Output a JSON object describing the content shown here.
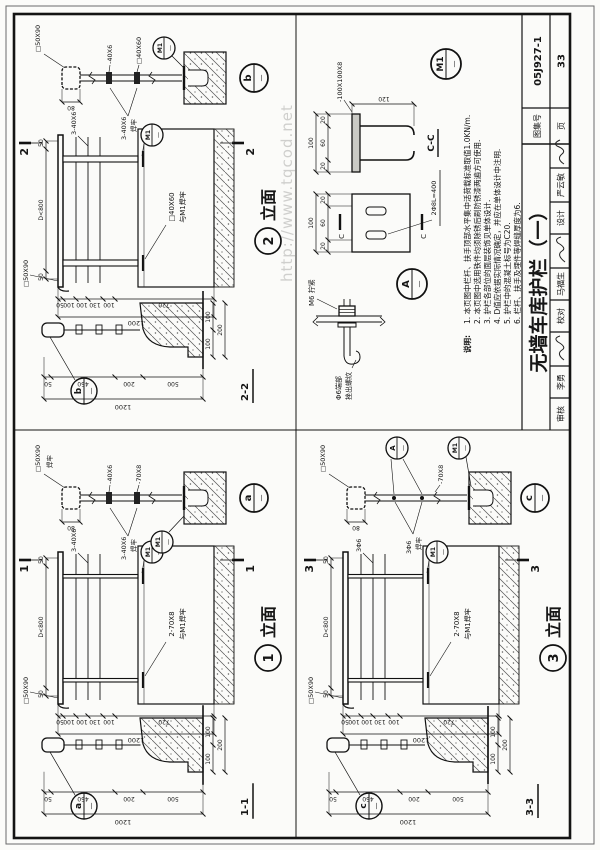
{
  "watermark": "http://www.tqcod.net",
  "title_block": {
    "title": "无墙车库护栏（一）",
    "signers": [
      {
        "label": "审核",
        "name": "李勇"
      },
      {
        "label": "校对",
        "name": "马福生"
      },
      {
        "label": "设计",
        "name": "严云敏"
      }
    ],
    "atlas_label": "图集号",
    "atlas_no": "05J927-1",
    "page_label": "页",
    "page_no": "33"
  },
  "notes": {
    "heading": "说明:",
    "items": [
      "1. 本页图中栏杆、扶手顶部水平集中活荷载标准取值1.0KN/m.",
      "2. 本页图中选用铁件均须除锈后刷防锈漆两遍方可使用.",
      "3. 护栏各部位的面层装饰见单体设计.",
      "4. D值应依据实际情况确定，并应在单体设计中注明.",
      "5. 护栏中的混凝土标号为C20.",
      "6. 栏杆、扶手及埋件等焊缝厚度为6."
    ]
  },
  "sections": {
    "s1": {
      "name": "1-1",
      "bubble": "a",
      "ref": "—",
      "vdims": [
        "50",
        "450",
        "200",
        "500"
      ],
      "vtotal": "1200",
      "hdims": [
        "100",
        "100"
      ],
      "htotal": "200"
    },
    "s2": {
      "name": "2-2",
      "bubble": "b",
      "ref": "—",
      "vdims": [
        "50",
        "450",
        "200",
        "500"
      ],
      "vtotal": "1200",
      "hdims": [
        "100",
        "100"
      ],
      "htotal": "200"
    },
    "s3": {
      "name": "3-3",
      "bubble": "c",
      "ref": "—",
      "vdims": [
        "50",
        "450",
        "200",
        "500"
      ],
      "vtotal": "1200",
      "hdims": [
        "100",
        "100"
      ],
      "htotal": "200"
    }
  },
  "elevations": {
    "e1": {
      "cut": "1",
      "num": "1",
      "suffix": "立面",
      "handrail": "□50X90",
      "rails": "3-40X6",
      "post1": "2-70X8",
      "post2": "与M1焊牢",
      "embed": "M1",
      "ref": "—",
      "top": [
        "50",
        "D<800",
        "50"
      ],
      "side": [
        "50",
        "100",
        "100",
        "130",
        "100",
        "720"
      ],
      "total": "1200"
    },
    "e2": {
      "cut": "2",
      "num": "2",
      "suffix": "立面",
      "handrail": "□50X90",
      "rails": "3-40X6",
      "post1": "□40X60",
      "post2": "与M1焊牢",
      "embed": "M1",
      "ref": "—",
      "top": [
        "50",
        "D<800",
        "50"
      ],
      "side": [
        "50",
        "100",
        "100",
        "130",
        "100",
        "720"
      ],
      "total": "1200"
    },
    "e3": {
      "cut": "3",
      "num": "3",
      "suffix": "立面",
      "handrail": "□50X90",
      "rails": "3Φ6",
      "post1": "2-70X8",
      "post2": "与M1焊牢",
      "embed": "M1",
      "ref": "—",
      "top": [
        "50",
        "D<800",
        "50"
      ],
      "side": [
        "50",
        "100",
        "100",
        "130",
        "100",
        "720"
      ],
      "total": "1200"
    }
  },
  "details": {
    "a": {
      "bubble": "a",
      "ref": "—",
      "cap": "□50X90",
      "cap2": "焊牢",
      "dim": "80",
      "bar1": "-40X6",
      "bar2": "-70X8",
      "weld1": "3-40X6",
      "weld2": "焊牢",
      "embed": "M1"
    },
    "b": {
      "bubble": "b",
      "ref": "—",
      "cap": "□50X90",
      "dim": "80",
      "bar1": "-40X6",
      "bar2": "□40X60",
      "weld1": "3-40X6",
      "weld2": "焊牢",
      "embed": "M1"
    },
    "c": {
      "bubble": "c",
      "ref": "—",
      "cap": "□50X90",
      "dim": "80",
      "bar1": "-70X8",
      "weld1": "3Φ6",
      "weld2": "焊牢",
      "embed": "M1",
      "bolt": "A"
    }
  },
  "m1_detail": {
    "bubble": "M1",
    "ref": "—",
    "plate": "-100X100X8",
    "anchors": "2Φ8L=400",
    "sec": "C-C",
    "cut": "C",
    "t1": "100",
    "s1": [
      "20",
      "60",
      "20"
    ],
    "t2": "100",
    "s2": [
      "20",
      "60",
      "20"
    ],
    "depth": "120"
  },
  "a_detail": {
    "bubble": "A",
    "ref": "—",
    "nut": "M6 拧紧",
    "rod1": "Φ6端部",
    "rod2": "挫出螺纹"
  }
}
